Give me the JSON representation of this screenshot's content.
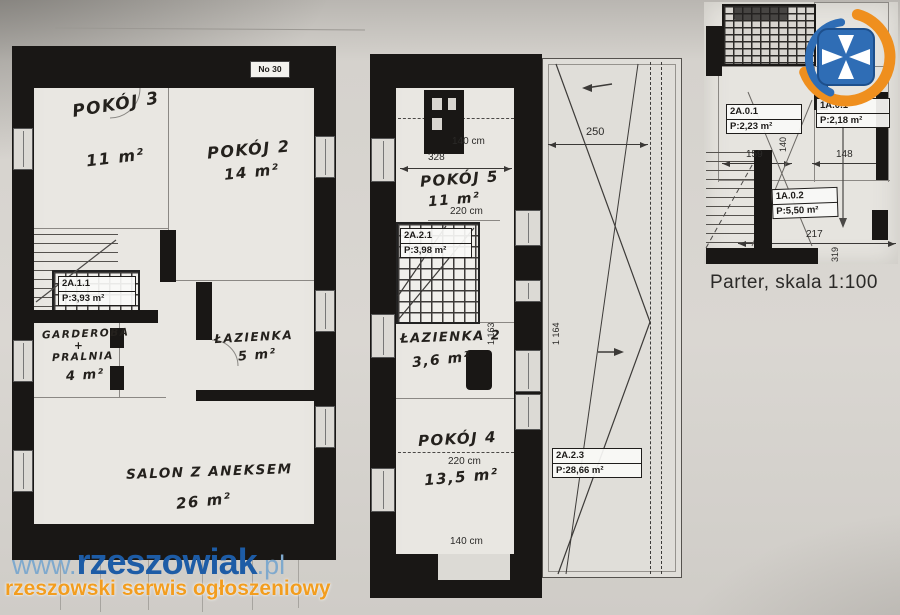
{
  "colors": {
    "brand_blue": "#1d5ca6",
    "brand_light_blue": "#7fa9cd",
    "brand_orange": "#f29d1f",
    "logo_blue": "#2f6db5",
    "logo_orange": "#ef8f1e",
    "ink": "#191715",
    "paper": "#d9d6d1"
  },
  "watermark": {
    "prefix": "www.",
    "brand": "rzeszowiak",
    "suffix": ".pl",
    "tagline": "rzeszowski serwis ogłoszeniowy"
  },
  "plan_left": {
    "stamp": "No 30",
    "pokoj3": {
      "label": "POKÓJ 3",
      "area": "11 m²"
    },
    "pokoj2": {
      "label": "POKÓJ 2",
      "area": "14 m²"
    },
    "garderoba": {
      "line1": "GARDEROBA",
      "line2": "+",
      "line3": "PRALNIA",
      "area": "4 m²"
    },
    "lazienka": {
      "label": "ŁAZIENKA",
      "area": "5 m²"
    },
    "salon": {
      "label": "SALON Z ANEKSEM",
      "area": "26 m²"
    },
    "stairs": {
      "id": "2A.1.1",
      "area": "P:3,93 m²"
    }
  },
  "plan_middle": {
    "pokoj5": {
      "label": "POKÓJ 5",
      "area": "11 m²",
      "width": "220 cm"
    },
    "lazienka2": {
      "label": "ŁAZIENKA 2",
      "area": "3,6 m²"
    },
    "pokoj4": {
      "label": "POKÓJ 4",
      "area": "13,5 m²",
      "width": "220 cm"
    },
    "stairs": {
      "id": "2A.2.1",
      "area": "P:3,98 m²"
    },
    "dims": {
      "top": "140 cm",
      "width": "328",
      "bottom": "140 cm",
      "height": "1 163"
    }
  },
  "terrace": {
    "label": {
      "id": "2A.2.3",
      "area": "P:28,66 m²"
    },
    "dims": {
      "width": "250",
      "height": "1 164"
    }
  },
  "plan_parter": {
    "room1": {
      "id": "2A.0.1",
      "area": "P:2,23 m²"
    },
    "room2": {
      "id": "1A.0.1",
      "area": "P:2,18 m²"
    },
    "room3": {
      "id": "1A.0.2",
      "area": "P:5,50 m²"
    },
    "dims": {
      "w1": "159",
      "h1": "140",
      "w2": "148",
      "w3": "217",
      "h2": "319"
    },
    "caption": "Parter, skala 1:100"
  }
}
